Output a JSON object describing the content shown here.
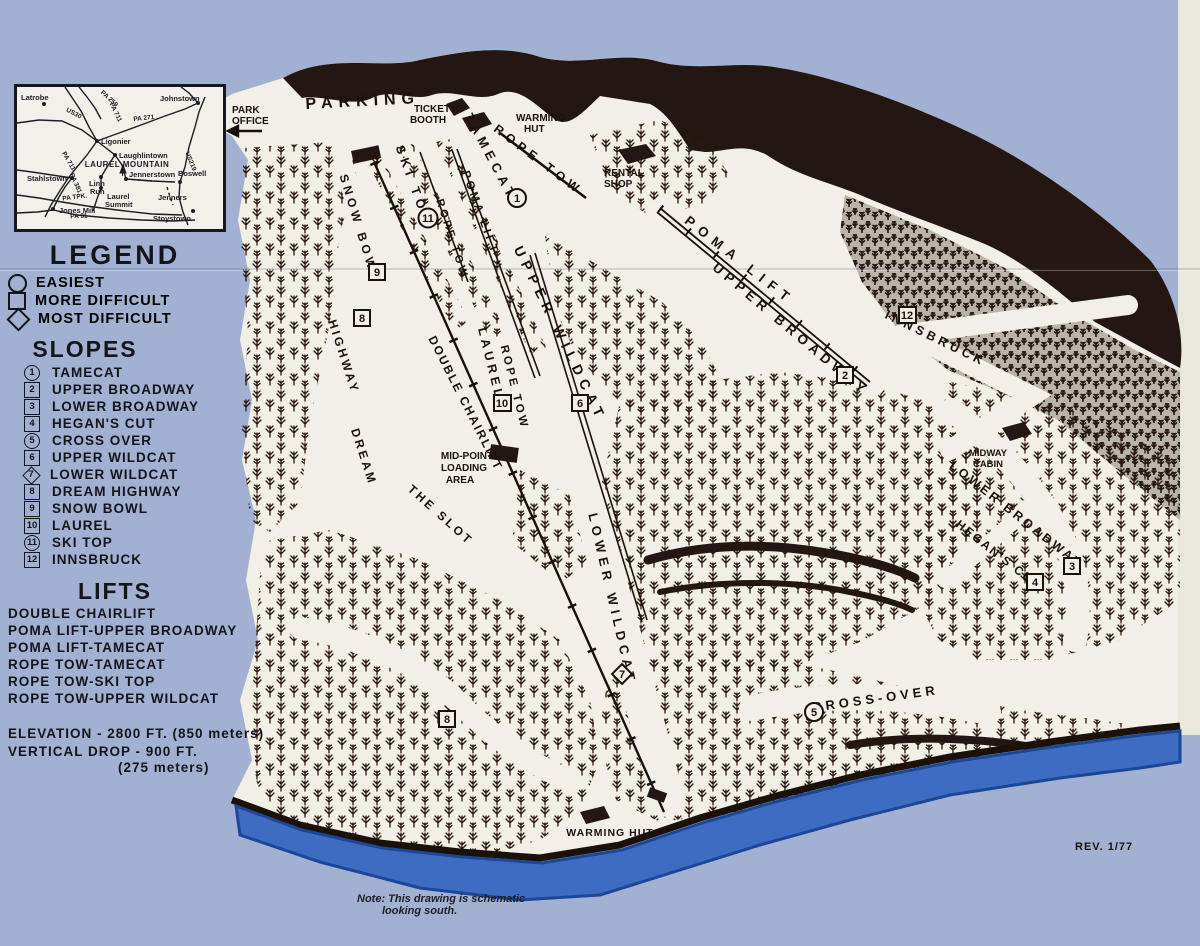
{
  "colors": {
    "sky_background": "#a2b1d1",
    "paper": "#f1efe6",
    "ink": "#241610",
    "water": "#3e6cc2",
    "water_dark_edge": "#1d4796"
  },
  "inset": {
    "mountain_label": "LAUREL MOUNTAIN",
    "towns": [
      {
        "name": "Latrobe"
      },
      {
        "name": "Johnstown"
      },
      {
        "name": "Ligonier"
      },
      {
        "name": "Laughlintown"
      },
      {
        "name": "Stahlstown"
      },
      {
        "name": "Linn"
      },
      {
        "name": "Run"
      },
      {
        "name": "Laurel"
      },
      {
        "name": "Summit"
      },
      {
        "name": "Jones Mill"
      },
      {
        "name": "Jennerstown"
      },
      {
        "name": "Boswell"
      },
      {
        "name": "Jenners"
      },
      {
        "name": "Stoystown"
      }
    ],
    "roads": [
      {
        "label": "PA 259"
      },
      {
        "label": "PA 711"
      },
      {
        "label": "US30"
      },
      {
        "label": "PA 271"
      },
      {
        "label": "PA 711"
      },
      {
        "label": "US219"
      },
      {
        "label": "PA 381"
      },
      {
        "label": "PA TPK."
      },
      {
        "label": "PA 31"
      }
    ]
  },
  "legend": {
    "title": "LEGEND",
    "items": [
      {
        "shape": "circle",
        "label": "EASIEST"
      },
      {
        "shape": "square",
        "label": "MORE DIFFICULT"
      },
      {
        "shape": "diamond",
        "label": "MOST DIFFICULT"
      }
    ]
  },
  "slopes": {
    "title": "SLOPES",
    "items": [
      {
        "num": "1",
        "shape": "circle",
        "name": "TAMECAT"
      },
      {
        "num": "2",
        "shape": "square",
        "name": "UPPER BROADWAY"
      },
      {
        "num": "3",
        "shape": "square",
        "name": "LOWER BROADWAY"
      },
      {
        "num": "4",
        "shape": "square",
        "name": "HEGAN'S CUT"
      },
      {
        "num": "5",
        "shape": "circle",
        "name": "CROSS OVER"
      },
      {
        "num": "6",
        "shape": "square",
        "name": "UPPER WILDCAT"
      },
      {
        "num": "7",
        "shape": "diamond",
        "name": "LOWER WILDCAT"
      },
      {
        "num": "8",
        "shape": "square",
        "name": "DREAM HIGHWAY"
      },
      {
        "num": "9",
        "shape": "square",
        "name": "SNOW BOWL"
      },
      {
        "num": "10",
        "shape": "square",
        "name": "LAUREL"
      },
      {
        "num": "11",
        "shape": "circle",
        "name": "SKI TOP"
      },
      {
        "num": "12",
        "shape": "square",
        "name": "INNSBRUCK"
      }
    ]
  },
  "lifts": {
    "title": "LIFTS",
    "items": [
      {
        "name": "DOUBLE CHAIRLIFT"
      },
      {
        "name": "POMA LIFT-UPPER BROADWAY"
      },
      {
        "name": "POMA LIFT-TAMECAT"
      },
      {
        "name": "ROPE TOW-TAMECAT"
      },
      {
        "name": "ROPE TOW-SKI TOP"
      },
      {
        "name": "ROPE TOW-UPPER WILDCAT"
      }
    ]
  },
  "stats": {
    "elevation": "ELEVATION - 2800 FT. (850 meters)",
    "vertical_drop": "VERTICAL DROP - 900 FT.",
    "vertical_drop_metric": "(275 meters)"
  },
  "map": {
    "labels": {
      "parking": "PARKING",
      "park_office_1": "PARK",
      "park_office_2": "OFFICE",
      "ticket_booth_1": "TICKET",
      "ticket_booth_2": "BOOTH",
      "warming_hut_1": "WARMING",
      "warming_hut_2": "HUT",
      "rental_shop_1": "RENTAL",
      "rental_shop_2": "SHOP",
      "rope_tow": "ROPE TOW",
      "tamecat": "TAMECAT",
      "poma_lift": "POMA LIFT",
      "ski_top": "SKI TOP",
      "snow_bowl": "SNOW BOWL",
      "upper_broadway": "UPPER BROADWAY",
      "innsbruck": "INNSBRUCK",
      "upper_wildcat": "UPPER WILDCAT",
      "laurel": "LAUREL",
      "double_chairlift": "DOUBLE CHAIRLIFT",
      "dream": "DREAM",
      "highway": "HIGHWAY",
      "the_slot": "THE SLOT",
      "midpoint_1": "MID-POINT",
      "midpoint_2": "LOADING",
      "midpoint_3": "AREA",
      "lower_wildcat": "LOWER WILDCAT",
      "lower_broadway": "LOWER BROADWAY",
      "hegans_cut": "HEGAN'S CUT",
      "cross_over": "CROSS-OVER",
      "midway_1": "MIDWAY",
      "midway_2": "CABIN",
      "warming_hut_full": "WARMING HUT",
      "note_1": "Note: This drawing is schematic",
      "note_2": "looking south.",
      "rev": "REV. 1/77"
    }
  }
}
